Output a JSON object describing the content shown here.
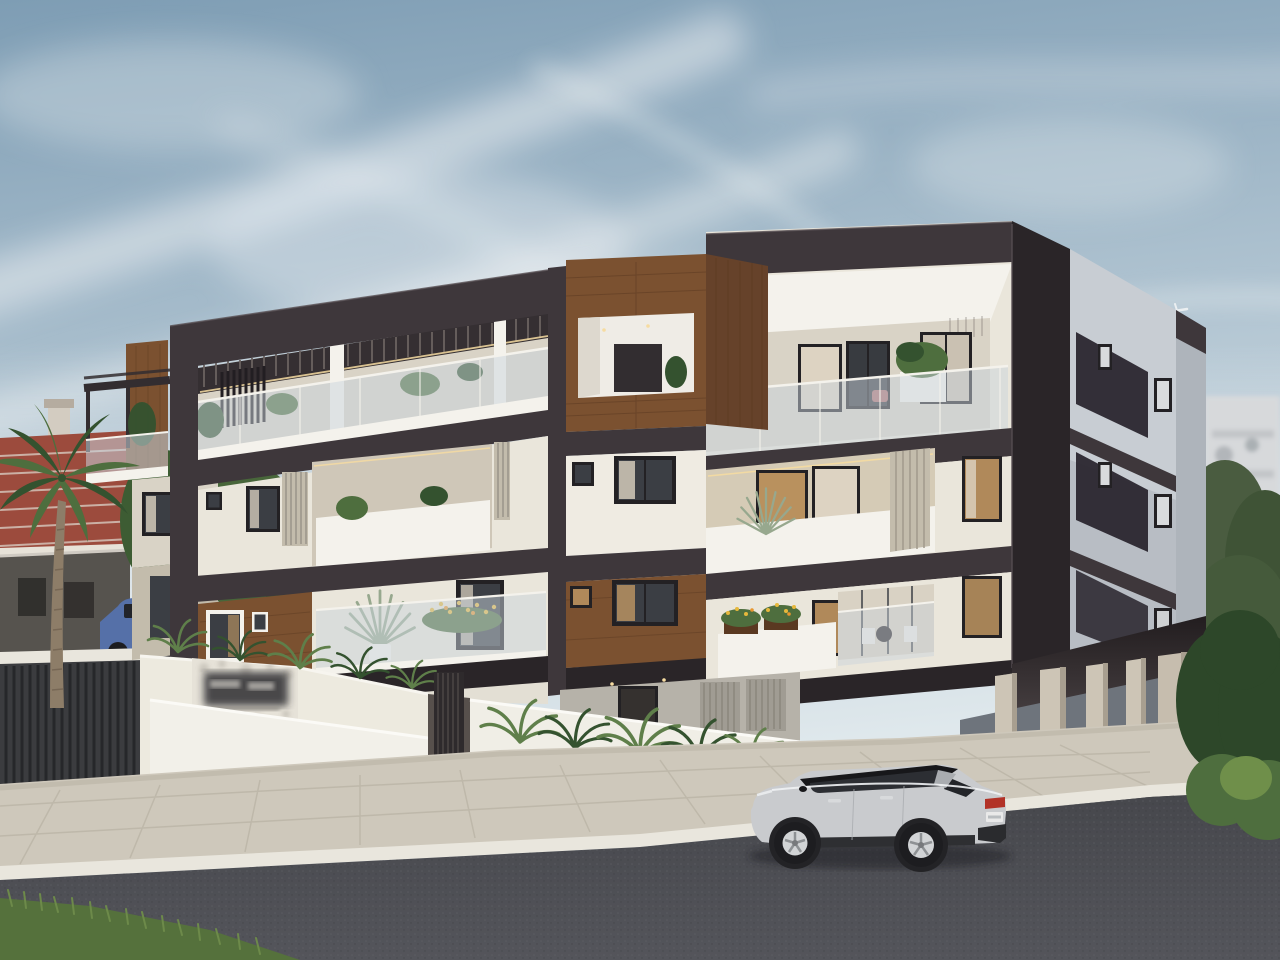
{
  "meta": {
    "title": "New three-storey apartment building — street view architectural render",
    "width_px": 1280,
    "height_px": 960
  },
  "scene": {
    "description": "Daytime photorealistic exterior render of a modern three-storey apartment block finished in cream render with dark charcoal banding and walnut wood cladding, frameless glass balconies and warm LED soffit lighting. In front: white planter walls with ferns, a beige paved sidewalk, a white curb and a dark asphalt road with a silver SUV parked on it. Left background: terracotta-roofed house, grey modern house, trees, a palm tree and parked cars behind a slatted fence. Right background: an out-of-focus white apartment block, olive trees and a clipped hedge. Blue-grey sky with wispy cirrus clouds and a tiny airliner.",
    "time_of_day": "day",
    "sky": {
      "clouds": "wispy cirrus streaks",
      "airplane": "tiny airliner above the right wing"
    },
    "signage": {
      "entrance_sign": "dark plaque on mottled feature wall — blurred / illegible",
      "license_plate": "white rear plate — blurred / illegible"
    }
  },
  "building": {
    "storeys_above_ground": 3,
    "ground_level": "pilotis car park with entrance lobby, louvre doors and metal gate",
    "materials": [
      "cream render",
      "charcoal frames and slabs",
      "walnut wood cladding",
      "frameless glass balustrades"
    ],
    "features": [
      "roof terrace with pergola slats",
      "recessed balconies with warm LED lighting",
      "vertical louvre screens",
      "planters with yellow flowers",
      "spiky potted palms on balconies",
      "intercom keypad at entrance"
    ]
  },
  "vehicles": [
    {
      "name": "silver-suv",
      "body_color": "silver",
      "roof_color": "black",
      "view": "rear three-quarter, parked on road"
    },
    {
      "name": "blue-pickup",
      "body_color": "blue",
      "location": "background street, left"
    },
    {
      "name": "dark-suv",
      "body_color": "graphite",
      "location": "background street, left"
    },
    {
      "name": "grey-car",
      "body_color": "grey",
      "location": "background street, left"
    },
    {
      "name": "silver-sedan",
      "body_color": "silver",
      "location": "background street, left"
    }
  ],
  "surroundings": {
    "left": [
      "terracotta tiled roof house with chimney",
      "grey modern house",
      "green trees",
      "palm tree",
      "dark slatted fence on white wall"
    ],
    "right": [
      "out-of-focus white apartment block with satellite dishes",
      "olive trees",
      "clipped hedge",
      "bright shrubs"
    ],
    "foreground": [
      "beige paved sidewalk",
      "white curb",
      "dark asphalt road",
      "grass patch in bottom-left corner"
    ]
  },
  "palette": {
    "sky_1": "#7e9db4",
    "sky_2": "#b7c9d5",
    "sky_3": "#dfe8ec",
    "cloud": "#f2f4f5",
    "charcoal": "#3e373b",
    "charcoal_dark": "#2a2528",
    "charcoal_light": "#514a4e",
    "cream": "#eae6db",
    "cream_shade": "#d9d3c6",
    "cream_dark": "#c3bcac",
    "white_trim": "#f4f2ec",
    "side_gray": "#c8cdd3",
    "side_gray_dark": "#aeb4bb",
    "wood": "#7b5130",
    "wood_dark": "#5a3921",
    "wood_side": "#66422a",
    "glass": "#c9d3dc",
    "win_frame": "#232124",
    "glazing": "#3b3e44",
    "warm_glow": "#d3a468",
    "curtain": "#ddd3c2",
    "led": "#f6dca2",
    "road_1": "#46474c",
    "road_2": "#54555b",
    "pave": "#cec8bb",
    "pave_line": "#b4ad9f",
    "curb": "#e9e6dd",
    "leaf": "#4e6e3e",
    "leaf_dark": "#34522f",
    "hedge": "#2d4729",
    "grass": "#5a7a40",
    "fern": "#5f7f4a",
    "palm_trunk": "#8d7d68",
    "roof_red": "#9c4b3d",
    "ridge": "#dbd2c8",
    "house_gray": "#56534e",
    "bg_bldg": "#d7d9db",
    "car_silver": "#c9cbce",
    "car_silver_2": "#a9acb0",
    "car_black": "#17171a",
    "car_glass": "#2c2e33",
    "tail_red": "#b23227",
    "plate": "#e9e9e9",
    "tire": "#1d1d20",
    "wheel": "#d2d4d6",
    "truck_blue": "#5570a8",
    "spiky": "#97a88e",
    "flower_yellow": "#e6b83c"
  }
}
